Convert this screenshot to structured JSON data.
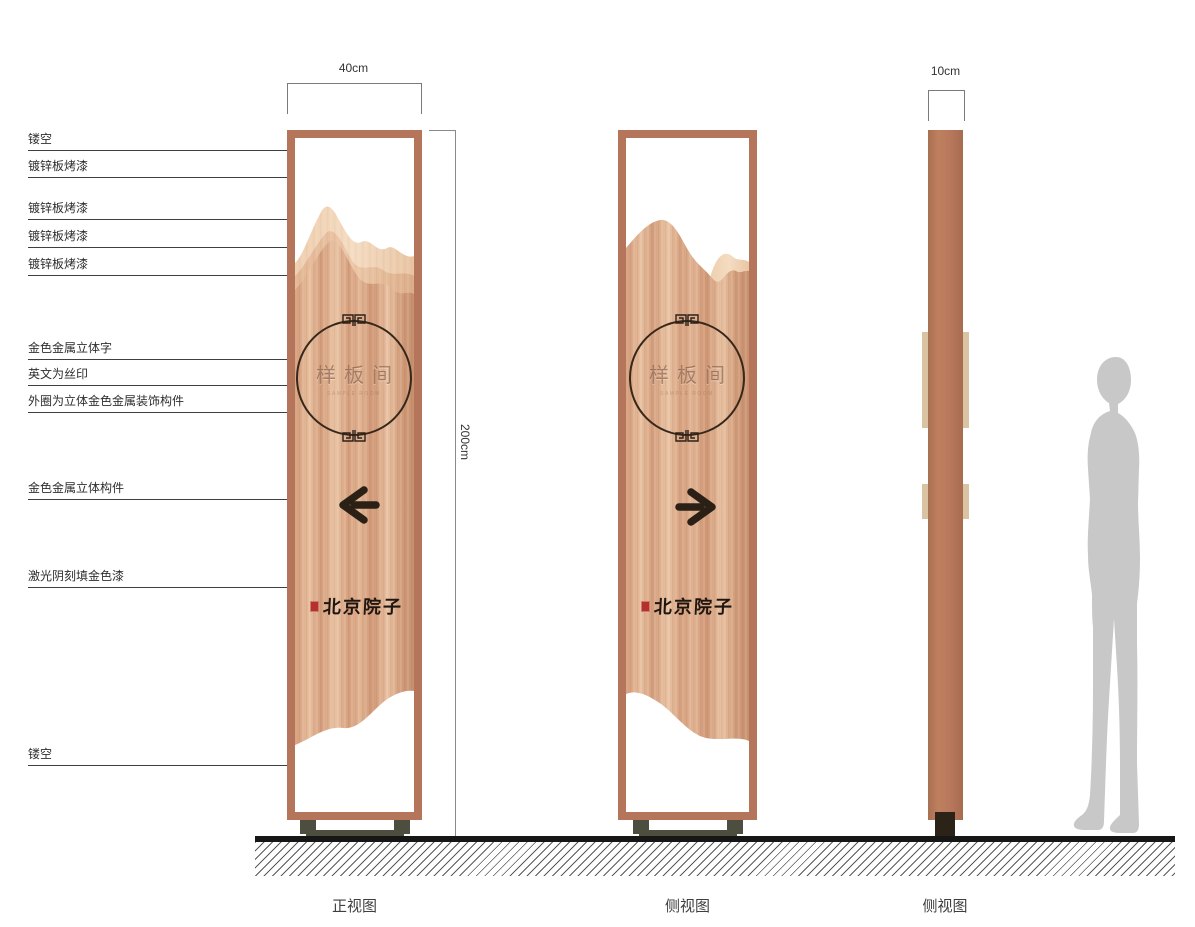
{
  "annotations": [
    {
      "label": "镂空"
    },
    {
      "label": "镀锌板烤漆"
    },
    {
      "label": "镀锌板烤漆"
    },
    {
      "label": "镀锌板烤漆"
    },
    {
      "label": "镀锌板烤漆"
    },
    {
      "label": "金色金属立体字"
    },
    {
      "label": "英文为丝印"
    },
    {
      "label": "外圈为立体金色金属装饰构件"
    },
    {
      "label": "金色金属立体构件"
    },
    {
      "label": "激光阴刻填金色漆"
    },
    {
      "label": "镂空"
    }
  ],
  "dimensions": {
    "front_width": "40cm",
    "height": "200cm",
    "side_depth": "10cm"
  },
  "sign": {
    "emblem_text": "样板间",
    "emblem_subtext": "SAMPLE ROOM",
    "brand_text": "北京院子"
  },
  "views": [
    {
      "caption": "正视图"
    },
    {
      "caption": "侧视图"
    },
    {
      "caption": "侧视图"
    }
  ],
  "icons": {
    "front_arrow": "arrow-left-icon",
    "side_arrow": "arrow-right-icon",
    "emblem_ornament": "meander-icon",
    "seal": "seal-stamp-icon",
    "scale_figure": "person-silhouette"
  },
  "colors": {
    "frame_copper": "#b5755a",
    "panel_grain_base": "#ddab8b",
    "mountain_light": "#f0d2b5",
    "ring_dark": "#372819",
    "arrow_dark": "#2b2015",
    "base_feet": "#4d4d40",
    "ground_black": "#161616",
    "seal_red": "#b5322a",
    "silhouette_gray": "#c8c8c8"
  }
}
